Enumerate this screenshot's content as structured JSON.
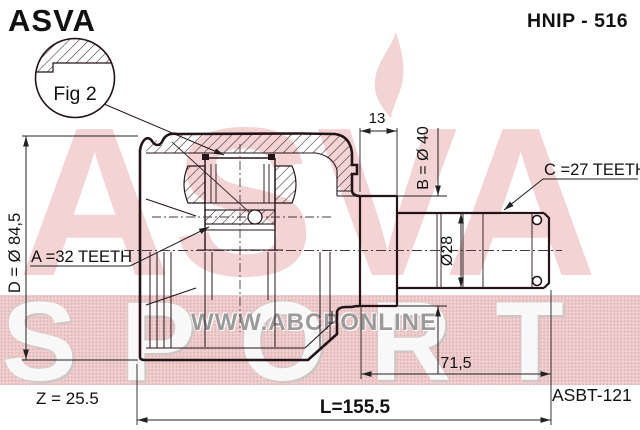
{
  "header": {
    "brand": "ASVA",
    "part_number": "HNIP - 516"
  },
  "figure": {
    "label": "Fig 2"
  },
  "dims": {
    "a": "A =32 TEETH",
    "b": "B = Ø 40",
    "c": "C =27 TEETH",
    "d": "D = Ø 84,5",
    "w13": "13",
    "shaft": "Ø28",
    "l71": "71,5",
    "z": "Z = 25.5",
    "l": "L=155.5"
  },
  "footer": {
    "ref": "ASBT-121"
  },
  "watermarks": {
    "asva": "ASVA",
    "sport": "SPORT",
    "url": "WWW.ABCPONLINE"
  },
  "colors": {
    "band_pink": "#efd0d0",
    "band_dot": "#e3b4b4",
    "wm_pink": "#f2cccc",
    "wm_gray": "#9a9a9a",
    "line": "#241418"
  }
}
